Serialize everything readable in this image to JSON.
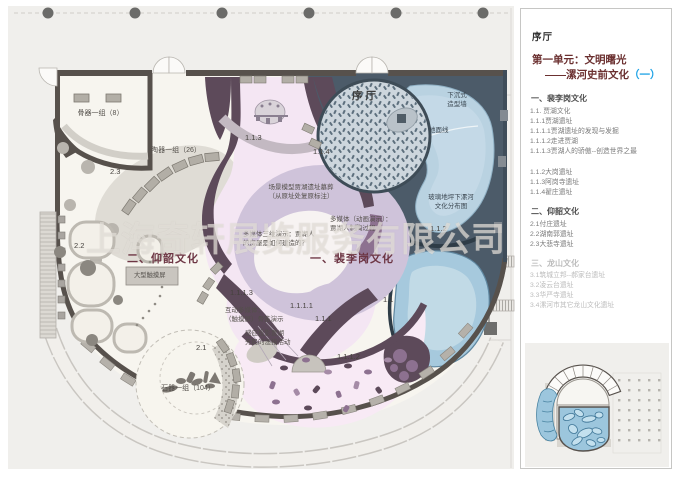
{
  "watermark": "上海奇轩展览服务有限公司",
  "panel": {
    "lobby": "序厅",
    "unit_title": "第一单元：文明曙光",
    "unit_subtitle": "——漯河史前文化",
    "unit_subtitle_mark": "（一）",
    "floor_label": "2F",
    "sections": [
      {
        "title": "一、裴李岗文化",
        "groups": [
          [
            "1.1. 贾湖文化",
            "1.1.1贾湖遗址",
            "1.1.1.1贾湖遗址的发现与发掘",
            "1.1.1.2走进贾湖",
            "1.1.1.3贾湖人的骄傲--创造世界之最"
          ],
          [
            "1.1.2大岗遗址",
            "1.1.3阿岗寺遗址",
            "1.1.4翟庄遗址"
          ]
        ]
      },
      {
        "title": "二、仰韶文化",
        "groups": [
          [
            "2.1付庄遗址",
            "2.2湖南郭遗址",
            "2.3大悲寺遗址"
          ]
        ]
      },
      {
        "title": "三、龙山文化",
        "groups": [
          [
            "3.1筑城立邦--郝家台遗址",
            "3.2凌云台遗址",
            "3.3华严寺遗址",
            "3.4漯河市其它龙山文化遗址"
          ]
        ]
      }
    ]
  },
  "plan": {
    "labels": {
      "bone_group": "骨器一组（8）",
      "pottery_group": "陶器一组（26）",
      "zone_2_3": "2.3",
      "zone_2_2": "2.2",
      "yangshao_title": "二、仰韶文化",
      "touch_screen": "大型触摸屏",
      "zone_2_1": "2.1",
      "stone_group": "石器一组（104）",
      "zone_1_1_3": "1.1.3",
      "zone_1_1_4": "1.1.4",
      "lobby": "序厅",
      "sunken_wall": "下沉式\n造型墙",
      "ground_line": "地面线",
      "glass_floor": "玻璃地坪下漯河\n文化分布图",
      "scene_model": "场景模型贾湖遗址墓葬\n（从原址处复原标注）",
      "media_anim": "多媒体（动画演示）：\n贾湖人制陶过程",
      "zone_1_1_2": "1.1.2",
      "media_3d": "多媒体三维演示：贾湖人\n的房屋是如何建造的？",
      "peiligang_title": "一、裴李岗文化",
      "zone_1_1_1_3": "1.1.1.3",
      "zone_1_1_1_1": "1.1.1.1",
      "zone_1_1_1": "1.1.1",
      "zone_1_1": "1.1",
      "interactive_media": "互动多媒体：\n（触摸屏）骨笛演示",
      "sensor_projection": "感应投影贾湖\n先民的渔猎活动",
      "zone_1_1_1_2": "1.1.1.2"
    }
  }
}
